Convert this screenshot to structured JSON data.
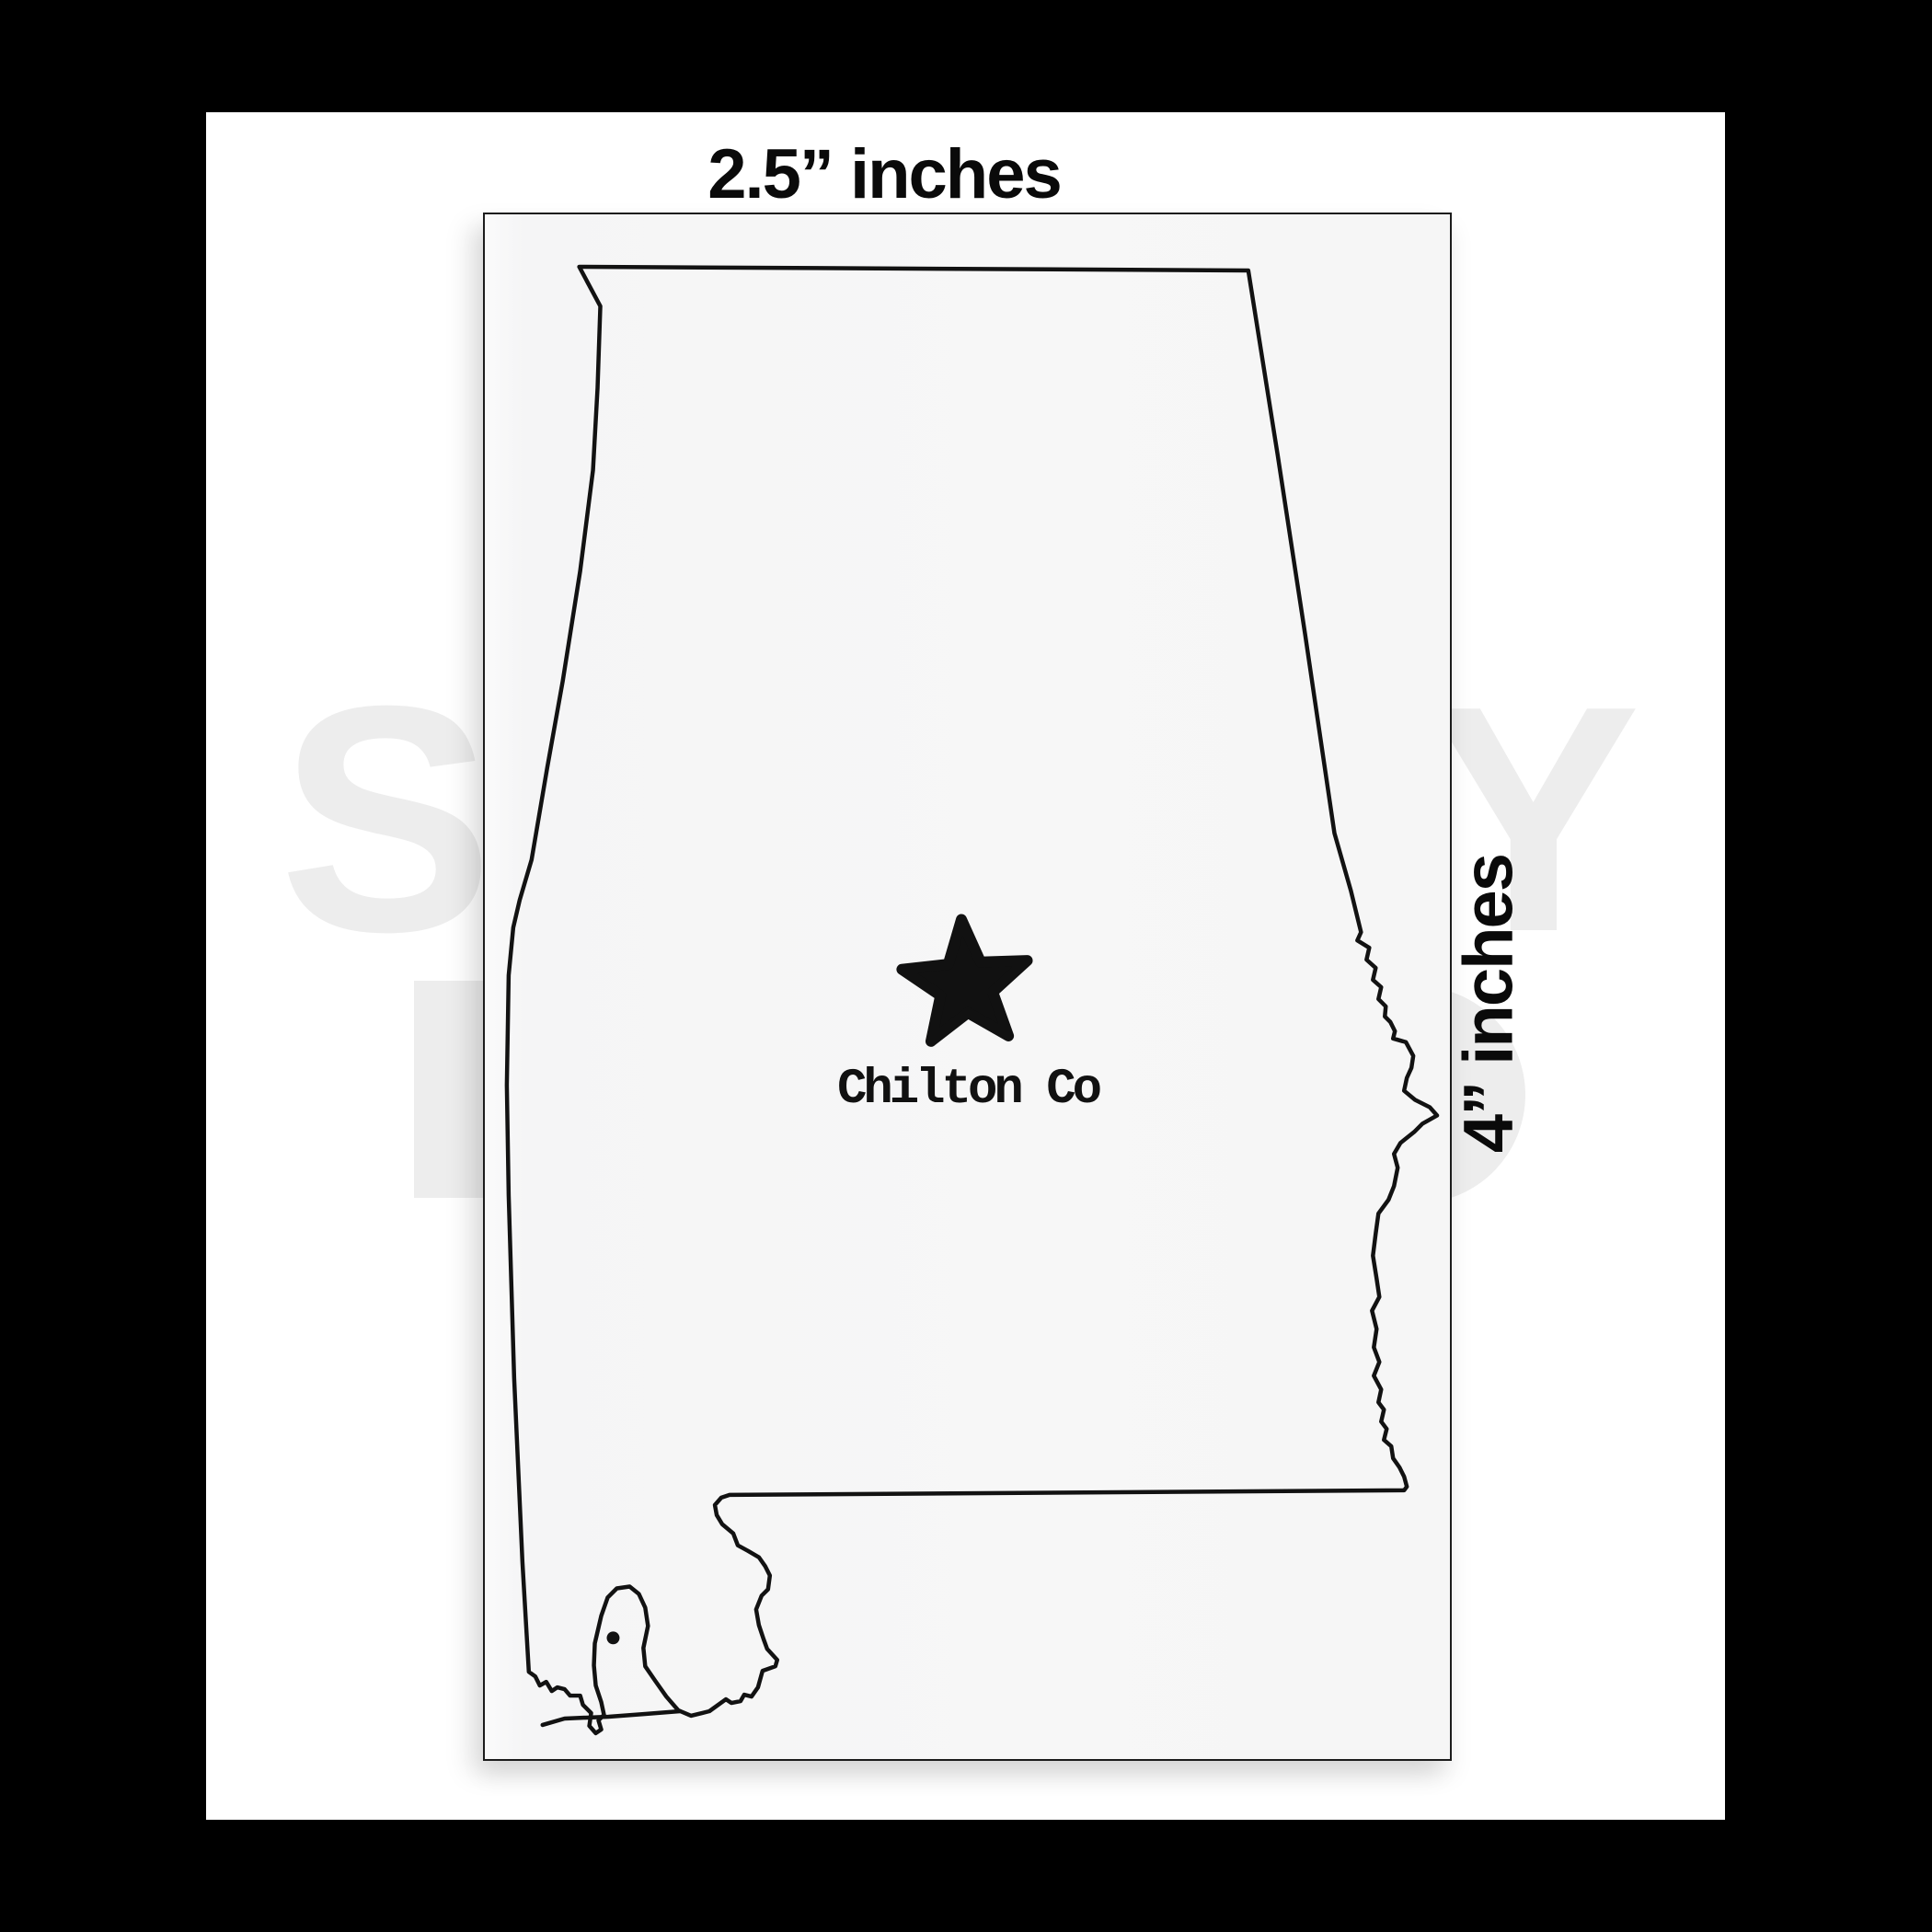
{
  "frame": {
    "outer_background": "#000000",
    "canvas_background": "#ffffff"
  },
  "mockup": {
    "top_dimension_label": "2.5” inches",
    "side_dimension_label": "4” inches",
    "sticker": {
      "state_shape": "Alabama",
      "county_label": "Chilton Co",
      "marker": "star",
      "background_color": "#f7f7f7",
      "outline_color": "#121212",
      "border_color": "#1c1c1c",
      "marker_color": "#111111"
    }
  },
  "watermark": {
    "color": "#ededed",
    "visible_letters": [
      "S",
      "Y"
    ]
  }
}
